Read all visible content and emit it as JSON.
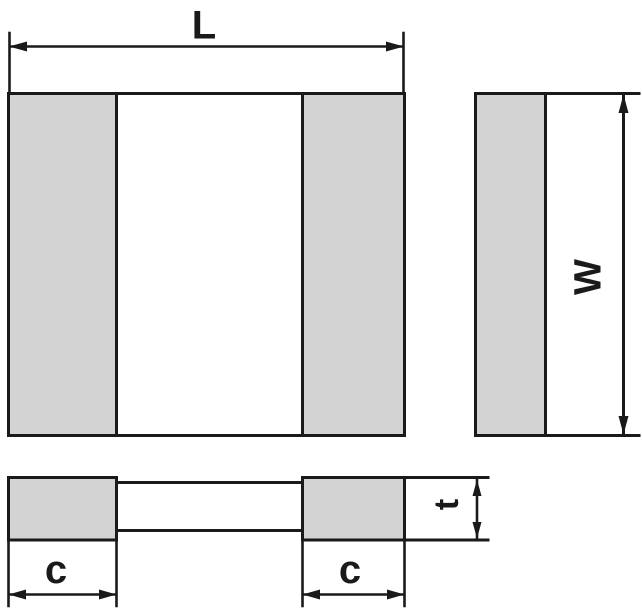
{
  "labels": {
    "length": "L",
    "width": "W",
    "thickness": "t",
    "terminal_left": "c",
    "terminal_right": "c"
  },
  "colors": {
    "line": "#1a1a1a",
    "terminal_fill": "#d3d3d3",
    "body_fill": "#ffffff",
    "background": "#ffffff"
  }
}
